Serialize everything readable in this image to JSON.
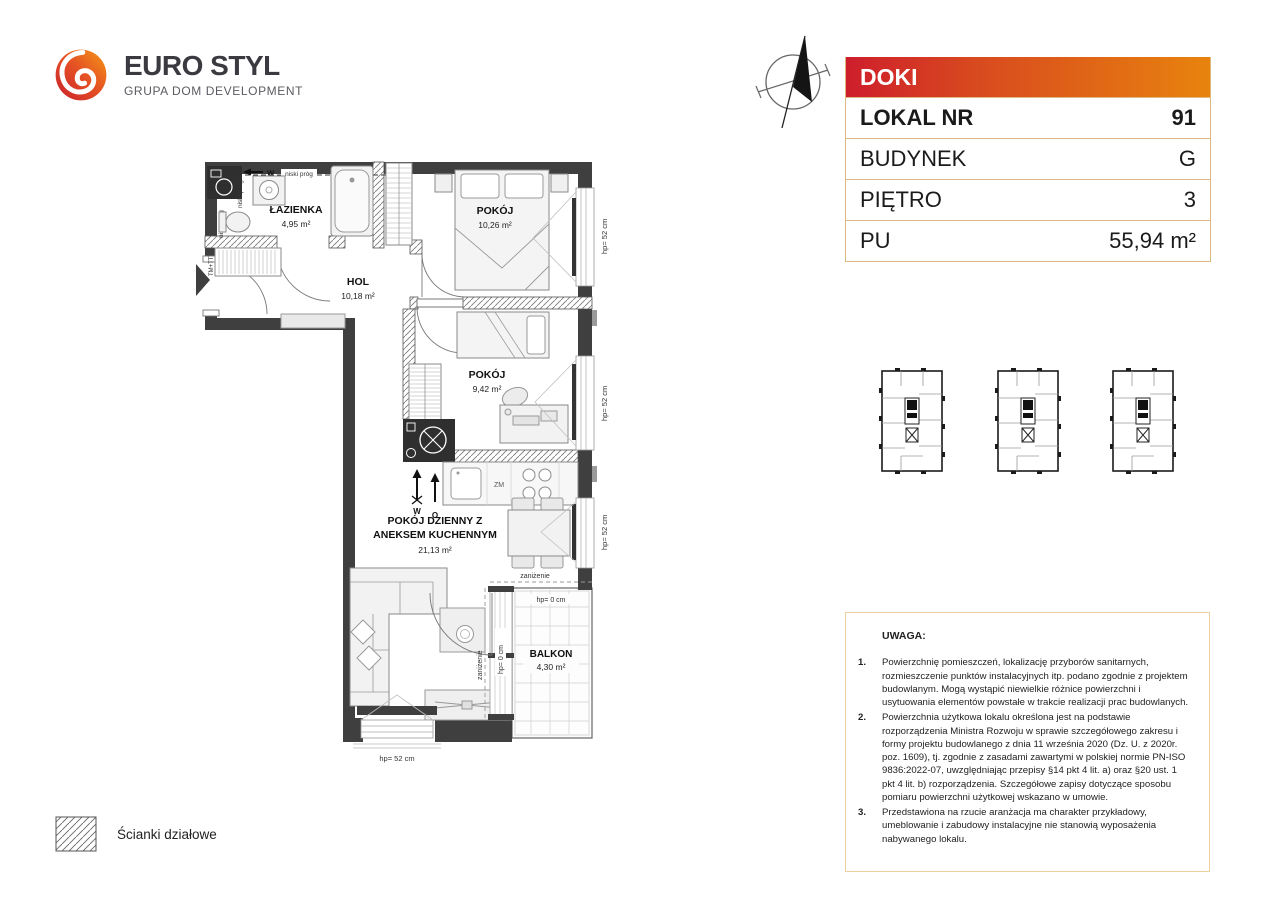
{
  "logo": {
    "brand": "EURO STYL",
    "tagline": "GRUPA DOM DEVELOPMENT"
  },
  "info_table": {
    "project": "DOKI",
    "rows": [
      {
        "label": "LOKAL NR",
        "value": "91"
      },
      {
        "label": "BUDYNEK",
        "value": "G"
      },
      {
        "label": "PIĘTRO",
        "value": "3"
      },
      {
        "label": "PU",
        "value": "55,94 m²"
      }
    ]
  },
  "colors": {
    "accent_red": "#ce1e2c",
    "accent_orange": "#e8830e",
    "table_border": "#dcba82",
    "wall": "#3f3f3f",
    "unit_highlight": "#8f8f8f"
  },
  "floor_plan": {
    "rooms": [
      {
        "name": "ŁAZIENKA",
        "area": "4,95 m²"
      },
      {
        "name": "HOL",
        "area": "10,18 m²"
      },
      {
        "name": "POKÓJ",
        "area": "10,26 m²"
      },
      {
        "name": "POKÓJ",
        "area": "9,42 m²"
      },
      {
        "name": "POKÓJ DZIENNY Z",
        "name2": "ANEKSEM KUCHENNYM",
        "area": "21,13 m²"
      },
      {
        "name": "BALKON",
        "area": "4,30 m²"
      }
    ],
    "annotations": {
      "hp52": "hp= 52 cm",
      "hp0": "hp= 0 cm",
      "niski_prog": "niski próg",
      "zanizenie": "zaniżenie",
      "zm": "ZM",
      "w": "W",
      "o": "O",
      "tm_tt": "TM+TT"
    }
  },
  "legend": {
    "label": "Ścianki działowe"
  },
  "notes": {
    "title": "UWAGA:",
    "items": [
      "Powierzchnię pomieszczeń, lokalizację przyborów sanitarnych, rozmieszczenie punktów instalacyjnych itp. podano zgodnie z projektem budowlanym. Mogą wystąpić niewielkie różnice powierzchni i usytuowania elementów powstałe w trakcie realizacji prac budowlanych.",
      "Powierzchnia użytkowa lokalu określona jest na podstawie rozporządzenia Ministra Rozwoju w sprawie szczegółowego zakresu i formy projektu budowlanego z dnia 11 września 2020 (Dz. U. z 2020r. poz. 1609), tj. zgodnie z zasadami zawartymi w polskiej normie PN-ISO 9836:2022-07, uwzględniając przepisy §14 pkt 4 lit. a) oraz §20 ust. 1 pkt 4 lit. b) rozporządzenia. Szczegółowe zapisy dotyczące sposobu pomiaru powierzchni użytkowej wskazano w umowie.",
      "Przedstawiona na rzucie aranżacja ma charakter przykładowy, umeblowanie i zabudowy instalacyjne nie stanowią wyposażenia nabywanego lokalu."
    ]
  }
}
